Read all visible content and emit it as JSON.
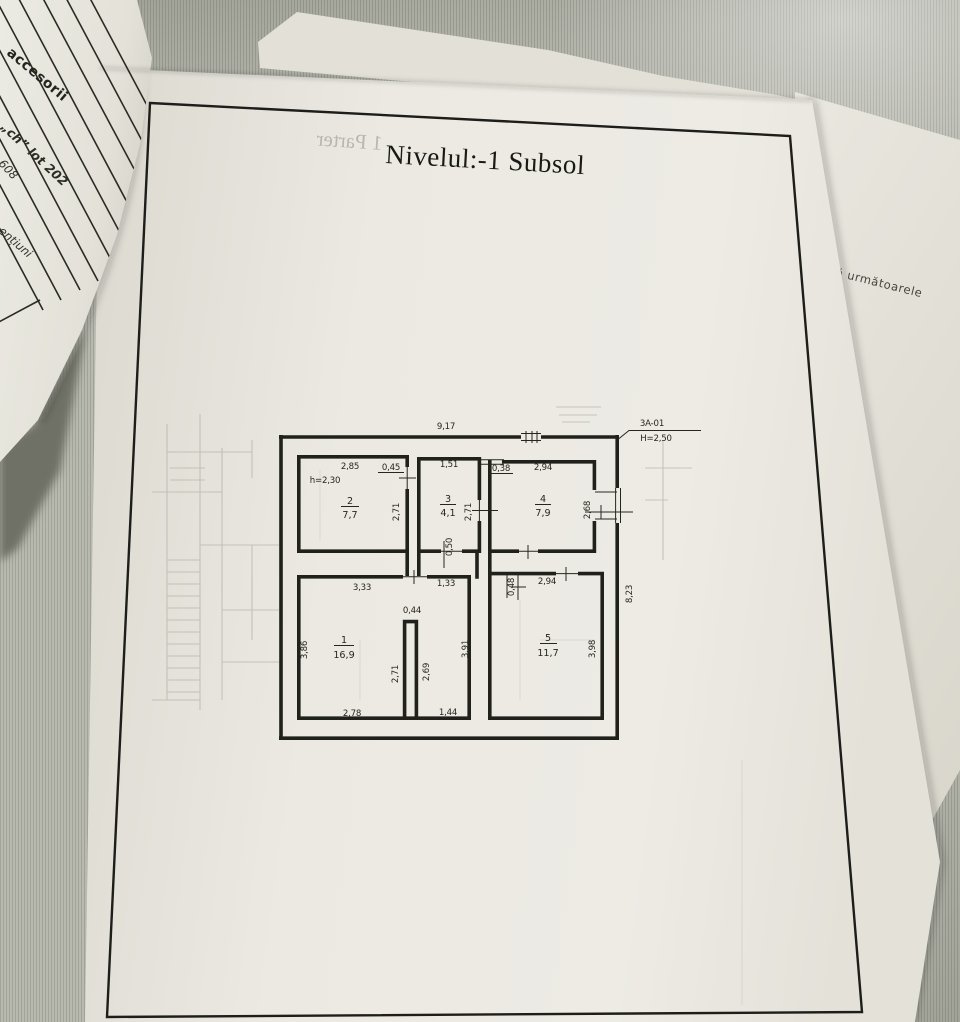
{
  "scene": {
    "left_paper": {
      "line1": "accesorii",
      "line2": "„ch” lot 202",
      "line3": "608",
      "line4": "ențiuni"
    },
    "right_sheet": {
      "text": "istă următoarele"
    },
    "main_page": {
      "title": "Nivelul:-1 Subsol",
      "bleed_text": "1 Parter"
    }
  },
  "floor_plan": {
    "reference": {
      "code": "3A-01",
      "height_note": "H=2,50"
    },
    "room_height_note": "h=2,30",
    "rooms": [
      {
        "number": "1",
        "area": "16,9"
      },
      {
        "number": "2",
        "area": "7,7"
      },
      {
        "number": "3",
        "area": "4,1"
      },
      {
        "number": "4",
        "area": "7,9"
      },
      {
        "number": "5",
        "area": "11,7"
      }
    ],
    "dimensions": {
      "top_width": "9,17",
      "right_height": "8,23",
      "r2_width": "2,85",
      "door_2_3": "0,45",
      "r3_width": "1,51",
      "door_3_4": "0,38",
      "r4_width": "2,94",
      "r2_depth": "2,71",
      "r3_depth": "2,71",
      "r4_depth": "2,68",
      "corridor_wall": "0,50",
      "r1_top_left": "3,33",
      "r1_top_right": "1,33",
      "r5_door": "0,48",
      "r5_width": "2,94",
      "r1_left": "3,86",
      "alcove_width": "0,44",
      "alcove_left": "2,71",
      "alcove_right": "2,69",
      "r1_right": "3,91",
      "r5_right": "3,98",
      "r1_bottom_left": "2,78",
      "r1_bottom_right": "1,44"
    }
  }
}
